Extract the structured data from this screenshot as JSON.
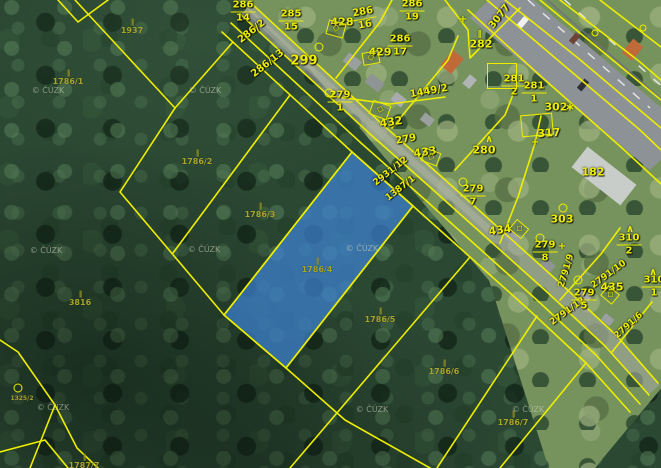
{
  "map": {
    "kind": "cadastral-aerial-hybrid-map",
    "provider_watermark": "© ČÚZK",
    "highlighted_parcel": {
      "number": "1786/4",
      "fill": "#3d82d2"
    },
    "colors": {
      "boundary_yellow": "#eded00",
      "label_bright": "#f2ee00",
      "label_dim": "#a8a42c",
      "watermark": "#ccd2b8",
      "forest_green": "#2b4833",
      "grass_green": "#76935e",
      "road_gray": "#a0a59a",
      "highway_gray": "#8d9296",
      "highlight_blue": "#3d82d2"
    },
    "labels": {
      "plain": [
        {
          "t": "428",
          "x": 342,
          "y": 22
        },
        {
          "t": "299",
          "x": 304,
          "y": 61,
          "s": 13
        },
        {
          "t": "429",
          "x": 380,
          "y": 52
        },
        {
          "t": "432",
          "x": 391,
          "y": 122,
          "r": -8
        },
        {
          "t": "279",
          "x": 406,
          "y": 140,
          "r": -10,
          "s": 10
        },
        {
          "t": "433",
          "x": 425,
          "y": 152,
          "r": -8
        },
        {
          "t": "434",
          "x": 500,
          "y": 230,
          "r": -8
        },
        {
          "t": "435",
          "x": 612,
          "y": 287
        },
        {
          "t": "303",
          "x": 562,
          "y": 219
        },
        {
          "t": "317",
          "x": 549,
          "y": 133,
          "r": -4
        },
        {
          "t": "280",
          "x": 484,
          "y": 150
        },
        {
          "t": "282",
          "x": 481,
          "y": 44
        },
        {
          "t": "182",
          "x": 593,
          "y": 172
        },
        {
          "t": "302",
          "x": 556,
          "y": 107
        },
        {
          "t": "3077",
          "x": 500,
          "y": 17,
          "r": -52,
          "s": 10
        },
        {
          "t": "286/2",
          "x": 252,
          "y": 32,
          "r": -38,
          "s": 10
        },
        {
          "t": "286/13",
          "x": 268,
          "y": 64,
          "r": -38,
          "s": 10
        },
        {
          "t": "1449/2",
          "x": 429,
          "y": 92,
          "r": -10,
          "s": 10
        },
        {
          "t": "2931/12",
          "x": 391,
          "y": 172,
          "r": -38,
          "s": 9
        },
        {
          "t": "1387/1",
          "x": 401,
          "y": 189,
          "r": -38,
          "s": 9
        },
        {
          "t": "2791/9",
          "x": 567,
          "y": 271,
          "r": -73,
          "s": 9
        },
        {
          "t": "2791/10",
          "x": 609,
          "y": 275,
          "r": -36,
          "s": 9
        },
        {
          "t": "2791/12",
          "x": 568,
          "y": 312,
          "r": -36,
          "s": 9
        },
        {
          "t": "2791/6",
          "x": 629,
          "y": 326,
          "r": -42,
          "s": 9
        }
      ],
      "fractions": [
        {
          "n": "286",
          "d": "14",
          "x": 243,
          "y": 12
        },
        {
          "n": "285",
          "d": "15",
          "x": 291,
          "y": 21
        },
        {
          "n": "286",
          "d": "16",
          "x": 364,
          "y": 19,
          "r": -10
        },
        {
          "n": "286",
          "d": "19",
          "x": 412,
          "y": 11
        },
        {
          "n": "286",
          "d": "17",
          "x": 400,
          "y": 46
        },
        {
          "n": "279",
          "d": "1",
          "x": 340,
          "y": 102
        },
        {
          "n": "281",
          "d": "2",
          "x": 514,
          "y": 86
        },
        {
          "n": "281",
          "d": "1",
          "x": 534,
          "y": 93
        },
        {
          "n": "279",
          "d": "7",
          "x": 473,
          "y": 196
        },
        {
          "n": "310",
          "d": "2",
          "x": 629,
          "y": 245
        },
        {
          "n": "279",
          "d": "8",
          "x": 545,
          "y": 252
        },
        {
          "n": "279",
          "d": "5",
          "x": 584,
          "y": 300
        },
        {
          "n": "310",
          "d": "1",
          "x": 654,
          "y": 287
        }
      ],
      "dim": [
        {
          "t": "1937",
          "x": 132,
          "y": 27
        },
        {
          "t": "1786/1",
          "x": 68,
          "y": 78
        },
        {
          "t": "1786/2",
          "x": 197,
          "y": 158
        },
        {
          "t": "1786/3",
          "x": 260,
          "y": 211
        },
        {
          "t": "1786/4",
          "x": 317,
          "y": 266
        },
        {
          "t": "3816",
          "x": 80,
          "y": 299
        },
        {
          "t": "1786/5",
          "x": 380,
          "y": 316
        },
        {
          "t": "1786/6",
          "x": 444,
          "y": 368
        },
        {
          "t": "1786/7",
          "x": 513,
          "y": 419
        },
        {
          "t": "1787/7",
          "x": 84,
          "y": 462
        },
        {
          "t": "1325/2",
          "x": 22,
          "y": 399,
          "s": 6,
          "nosym": true
        }
      ],
      "watermarks": [
        {
          "x": 48,
          "y": 91
        },
        {
          "x": 205,
          "y": 91
        },
        {
          "x": 46,
          "y": 251
        },
        {
          "x": 204,
          "y": 250
        },
        {
          "x": 362,
          "y": 249
        },
        {
          "x": 53,
          "y": 408
        },
        {
          "x": 372,
          "y": 410
        },
        {
          "x": 528,
          "y": 410
        }
      ]
    },
    "symbols": [
      {
        "k": "circle",
        "x": 319,
        "y": 47
      },
      {
        "k": "circle",
        "x": 329,
        "y": 93
      },
      {
        "k": "circle",
        "x": 463,
        "y": 182
      },
      {
        "k": "circle",
        "x": 563,
        "y": 208
      },
      {
        "k": "circle",
        "x": 540,
        "y": 238
      },
      {
        "k": "circle",
        "x": 578,
        "y": 280
      },
      {
        "k": "circle",
        "x": 18,
        "y": 388
      },
      {
        "k": "circle-small",
        "x": 595,
        "y": 33
      },
      {
        "k": "circle-small",
        "x": 643,
        "y": 28
      },
      {
        "k": "dbox",
        "x": 336,
        "y": 29,
        "w": 16,
        "h": 13,
        "r": 15
      },
      {
        "k": "dbox",
        "x": 371,
        "y": 58,
        "w": 15,
        "h": 11,
        "r": -10
      },
      {
        "k": "dbox",
        "x": 380,
        "y": 110,
        "w": 17,
        "h": 13,
        "r": 20
      },
      {
        "k": "dbox",
        "x": 431,
        "y": 157,
        "w": 15,
        "h": 12,
        "r": 20
      },
      {
        "k": "dbox",
        "x": 519,
        "y": 229,
        "w": 14,
        "h": 11,
        "r": 40
      },
      {
        "k": "dbox",
        "x": 610,
        "y": 295,
        "w": 13,
        "h": 11,
        "r": 40
      },
      {
        "k": "pbox",
        "x": 537,
        "y": 125,
        "w": 30,
        "h": 20,
        "r": -5
      },
      {
        "k": "pbox",
        "x": 502,
        "y": 76,
        "w": 28,
        "h": 24,
        "r": 0
      },
      {
        "k": "caret",
        "x": 489,
        "y": 140
      },
      {
        "k": "caret",
        "x": 630,
        "y": 230
      },
      {
        "k": "caret",
        "x": 653,
        "y": 273
      },
      {
        "k": "par",
        "x": 479,
        "y": 34
      },
      {
        "k": "star",
        "x": 570,
        "y": 107
      },
      {
        "k": "cross",
        "x": 463,
        "y": 20
      },
      {
        "k": "cross",
        "x": 535,
        "y": 143
      },
      {
        "k": "cross",
        "x": 562,
        "y": 247
      }
    ]
  }
}
